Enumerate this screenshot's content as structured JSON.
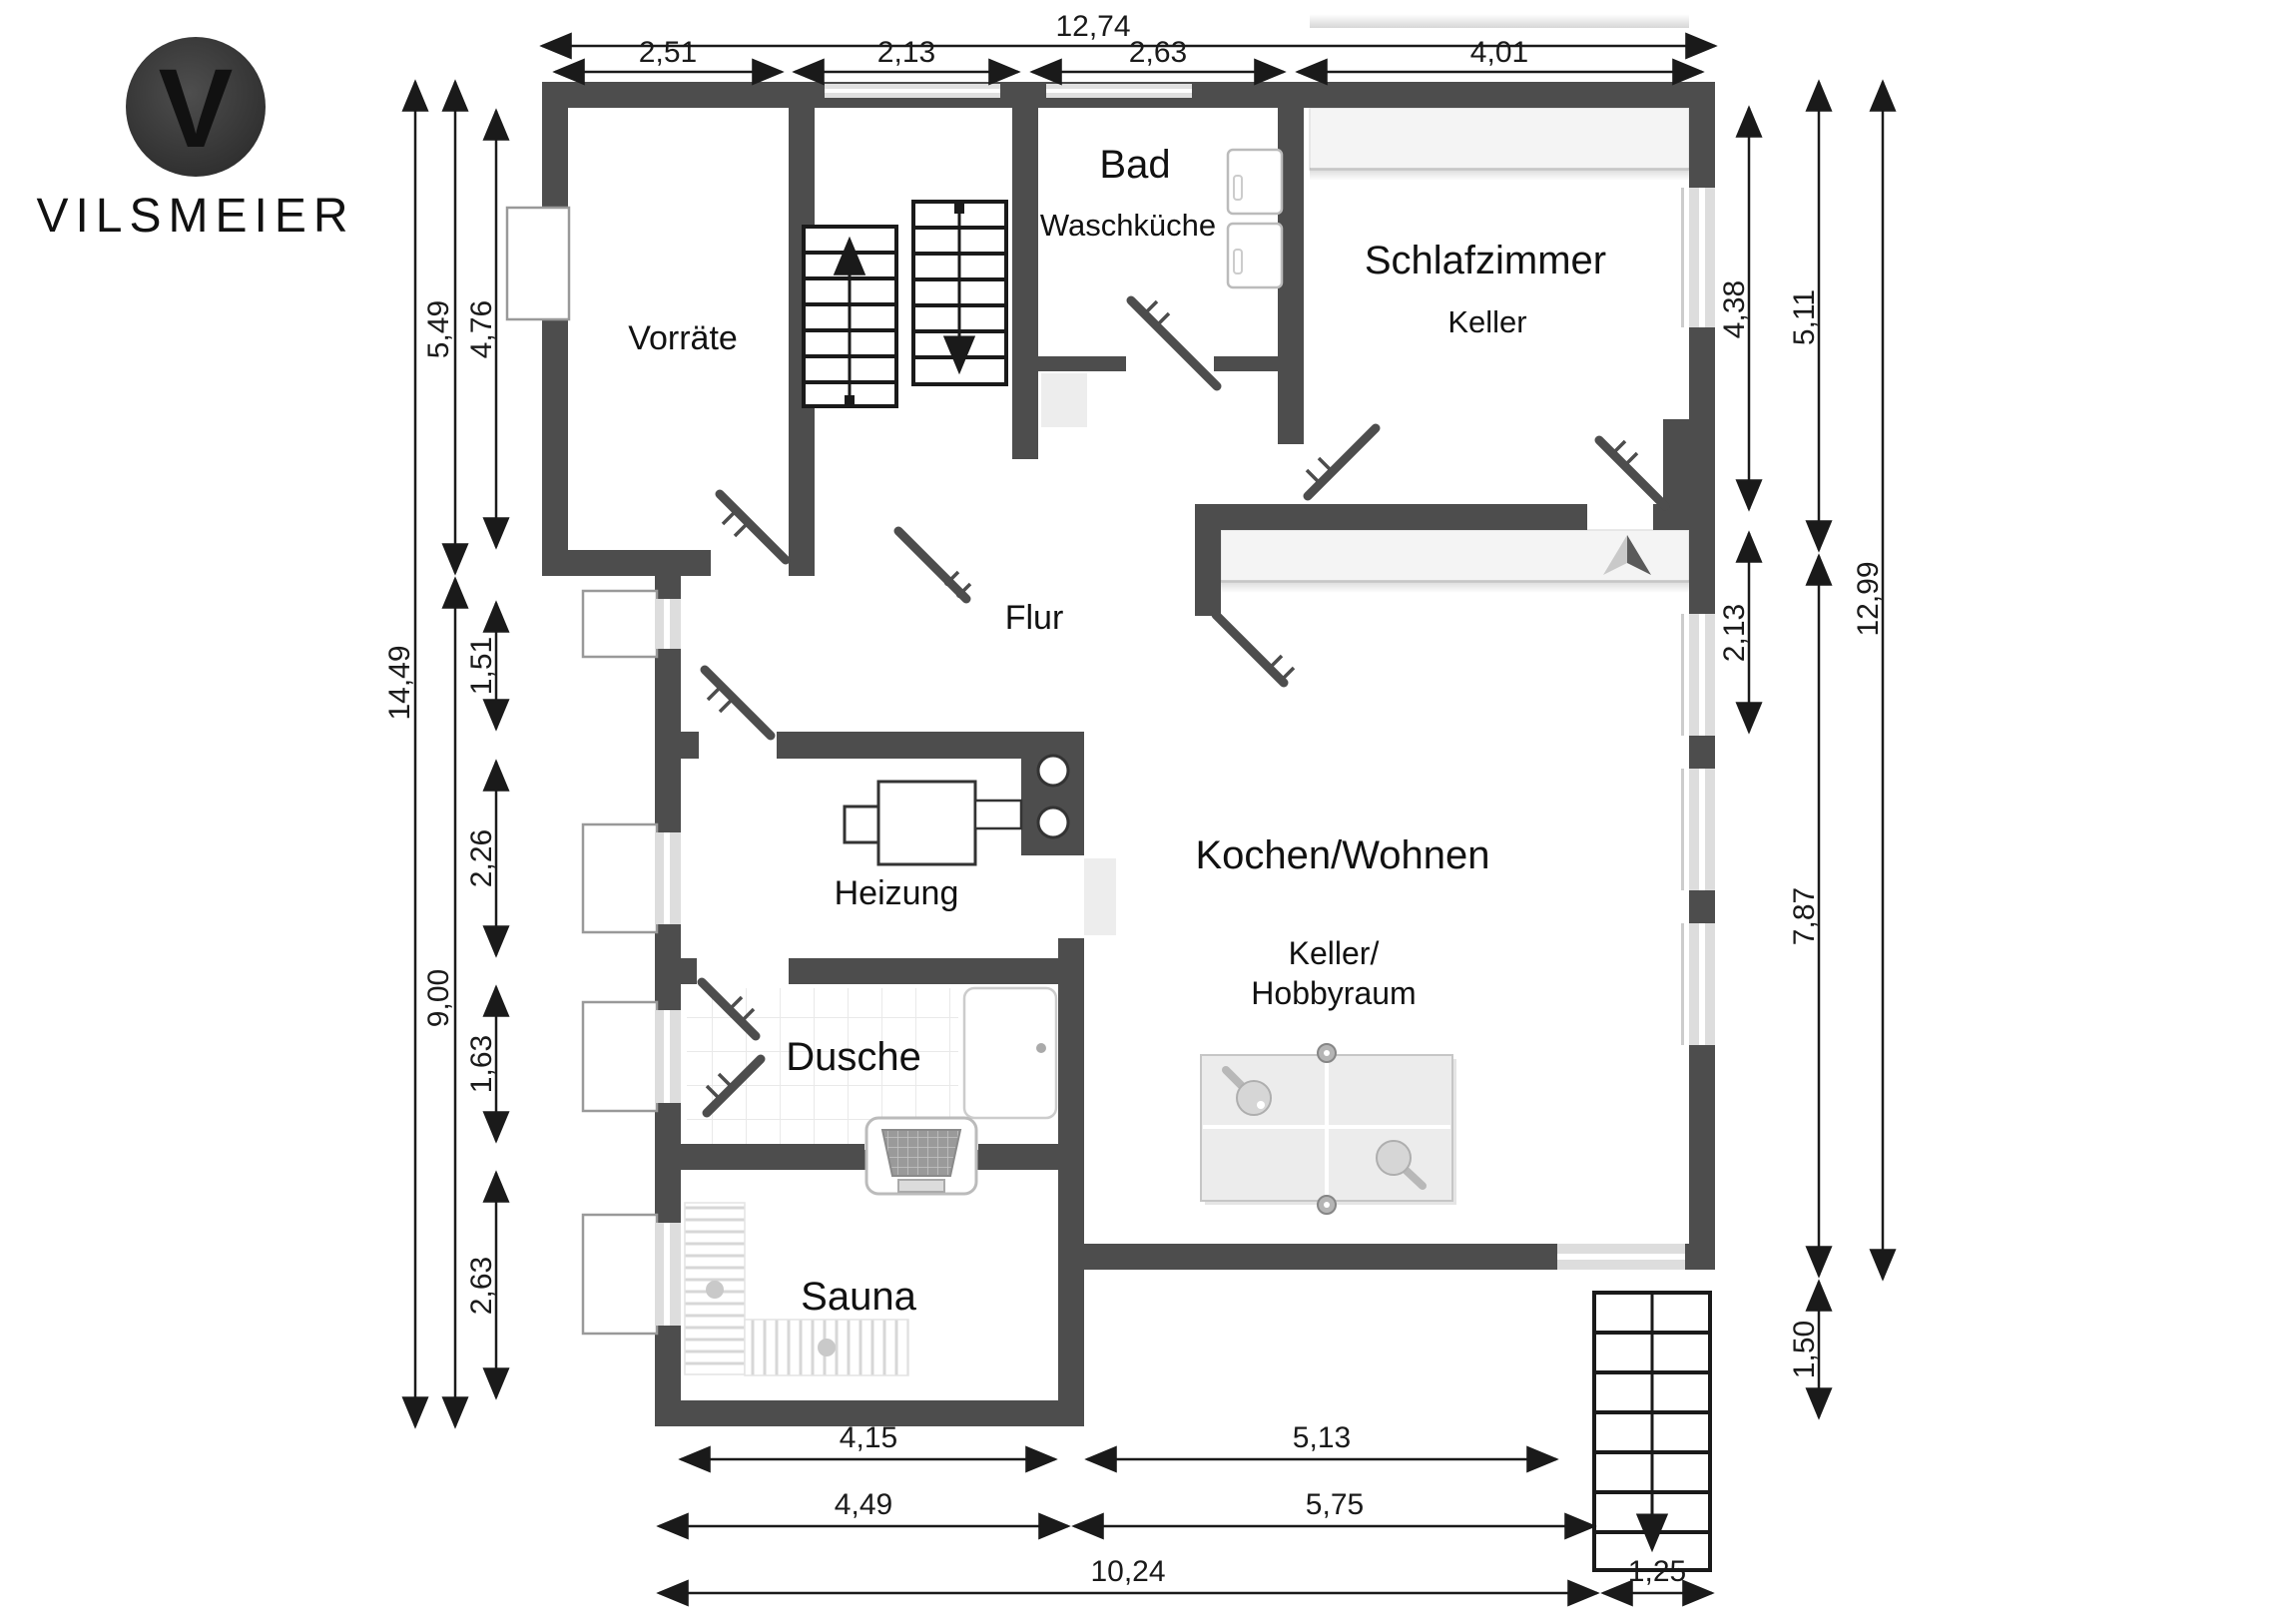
{
  "brand": {
    "logo_letter": "V",
    "name": "VILSMEIER"
  },
  "rooms": {
    "vorraete": "Vorräte",
    "bad": "Bad",
    "waschkueche": "Waschküche",
    "schlafzimmer": "Schlafzimmer",
    "schlafzimmer_sub": "Keller",
    "flur": "Flur",
    "heizung": "Heizung",
    "kochen_wohnen": "Kochen/Wohnen",
    "hobbyraum_line1": "Keller/",
    "hobbyraum_line2": "Hobbyraum",
    "dusche": "Dusche",
    "sauna": "Sauna"
  },
  "dims": {
    "top_total": "12,74",
    "top": [
      "2,51",
      "2,13",
      "2,63",
      "4,01"
    ],
    "left_total": "14,49",
    "left_mid": [
      "5,49",
      "9,00"
    ],
    "left_inner": [
      "4,76",
      "1,51",
      "2,26",
      "1,63",
      "2,63"
    ],
    "right_inner": [
      "4,38",
      "2,13"
    ],
    "right_mid": [
      "5,11",
      "7,87",
      "1,50"
    ],
    "right_total": "12,99",
    "bottom_a": [
      "4,15",
      "5,13"
    ],
    "bottom_b": [
      "4,49",
      "5,75"
    ],
    "bottom_c": [
      "10,24",
      "1,25"
    ]
  },
  "colors": {
    "wall": "#4d4d4d",
    "dimension_line": "#1a1a1a",
    "furniture_light": "#f3f3f3",
    "logo_circle": "#333333",
    "logo_text": "#565656"
  }
}
